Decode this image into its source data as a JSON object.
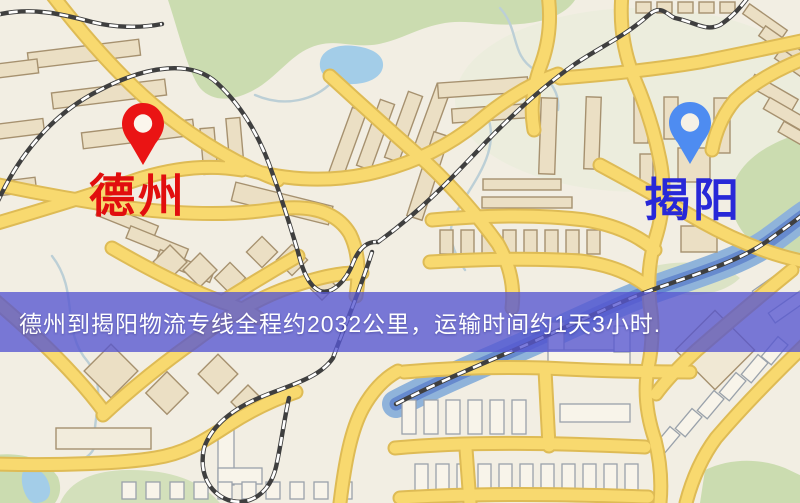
{
  "app": {
    "name": "logistics-route-map",
    "width_px": 800,
    "height_px": 503
  },
  "banner": {
    "text": "德州到揭阳物流专线全程约2032公里，运输时间约1天3小时.",
    "background_color": "#5656d1",
    "text_color": "#ffffff"
  },
  "route": {
    "origin_city": "德州",
    "destination_city": "揭阳",
    "distance_km": 2032,
    "duration": "1天3小时"
  },
  "markers": [
    {
      "id": "origin",
      "label": "德州",
      "label_color": "#e10e0e",
      "pin_color": "#ea1414",
      "pin_style": "red-map-pin"
    },
    {
      "id": "destination",
      "label": "揭阳",
      "label_color": "#2828d8",
      "pin_color": "#4e8cf1",
      "pin_style": "blue-map-pin"
    }
  ],
  "map": {
    "style": "street-map",
    "colors": {
      "background": "#f2eee3",
      "road_fill": "#f8d96f",
      "road_casing": "#debb55",
      "park_green": "#cbdcb0",
      "water_blue": "#a3cde8",
      "river_blue": "#5f82cb",
      "railway_dark": "#3f3f3f",
      "building_fill": "#ebdfc4",
      "building_outline": "#a6916f"
    }
  }
}
